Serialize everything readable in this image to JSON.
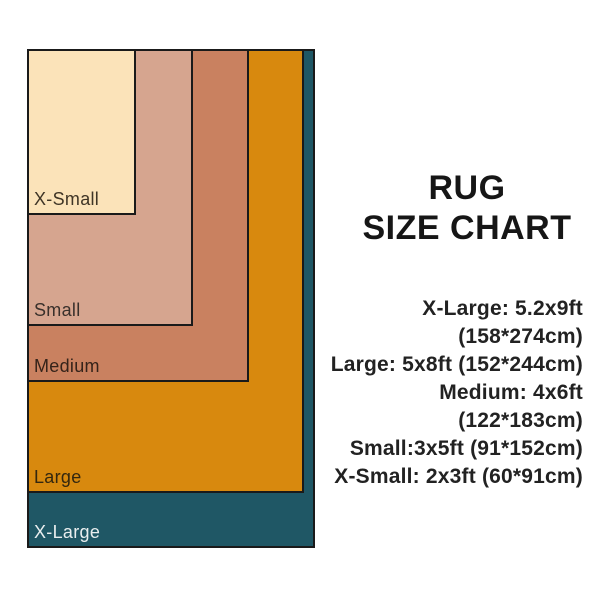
{
  "title": {
    "line1": "RUG",
    "line2": "SIZE CHART"
  },
  "spec_list": [
    "X-Large: 5.2x9ft (158*274cm)",
    "Large: 5x8ft (152*244cm)",
    "Medium: 4x6ft (122*183cm)",
    "Small:3x5ft (91*152cm)",
    "X-Small: 2x3ft (60*91cm)"
  ],
  "chart_data": {
    "type": "area",
    "title": "RUG SIZE CHART",
    "layout": "nested-rectangles-top-left-aligned",
    "unit": "cm",
    "scale_px_per_cm": 1.82,
    "background": "#ffffff",
    "border_color": "#1a1a1a",
    "series": [
      {
        "name": "X-Large",
        "feet": "5.2x9ft",
        "cm_width": 158,
        "cm_height": 274,
        "color": "#1f5765",
        "label_color": "#e9eeef"
      },
      {
        "name": "Large",
        "feet": "5x8ft",
        "cm_width": 152,
        "cm_height": 244,
        "color": "#d8890e",
        "label_color": "#33270f"
      },
      {
        "name": "Medium",
        "feet": "4x6ft",
        "cm_width": 122,
        "cm_height": 183,
        "color": "#c98160",
        "label_color": "#35231a"
      },
      {
        "name": "Small",
        "feet": "3x5ft",
        "cm_width": 91,
        "cm_height": 152,
        "color": "#d6a58f",
        "label_color": "#39302b"
      },
      {
        "name": "X-Small",
        "feet": "2x3ft",
        "cm_width": 60,
        "cm_height": 91,
        "color": "#fbe3b9",
        "label_color": "#3f3526"
      }
    ]
  }
}
